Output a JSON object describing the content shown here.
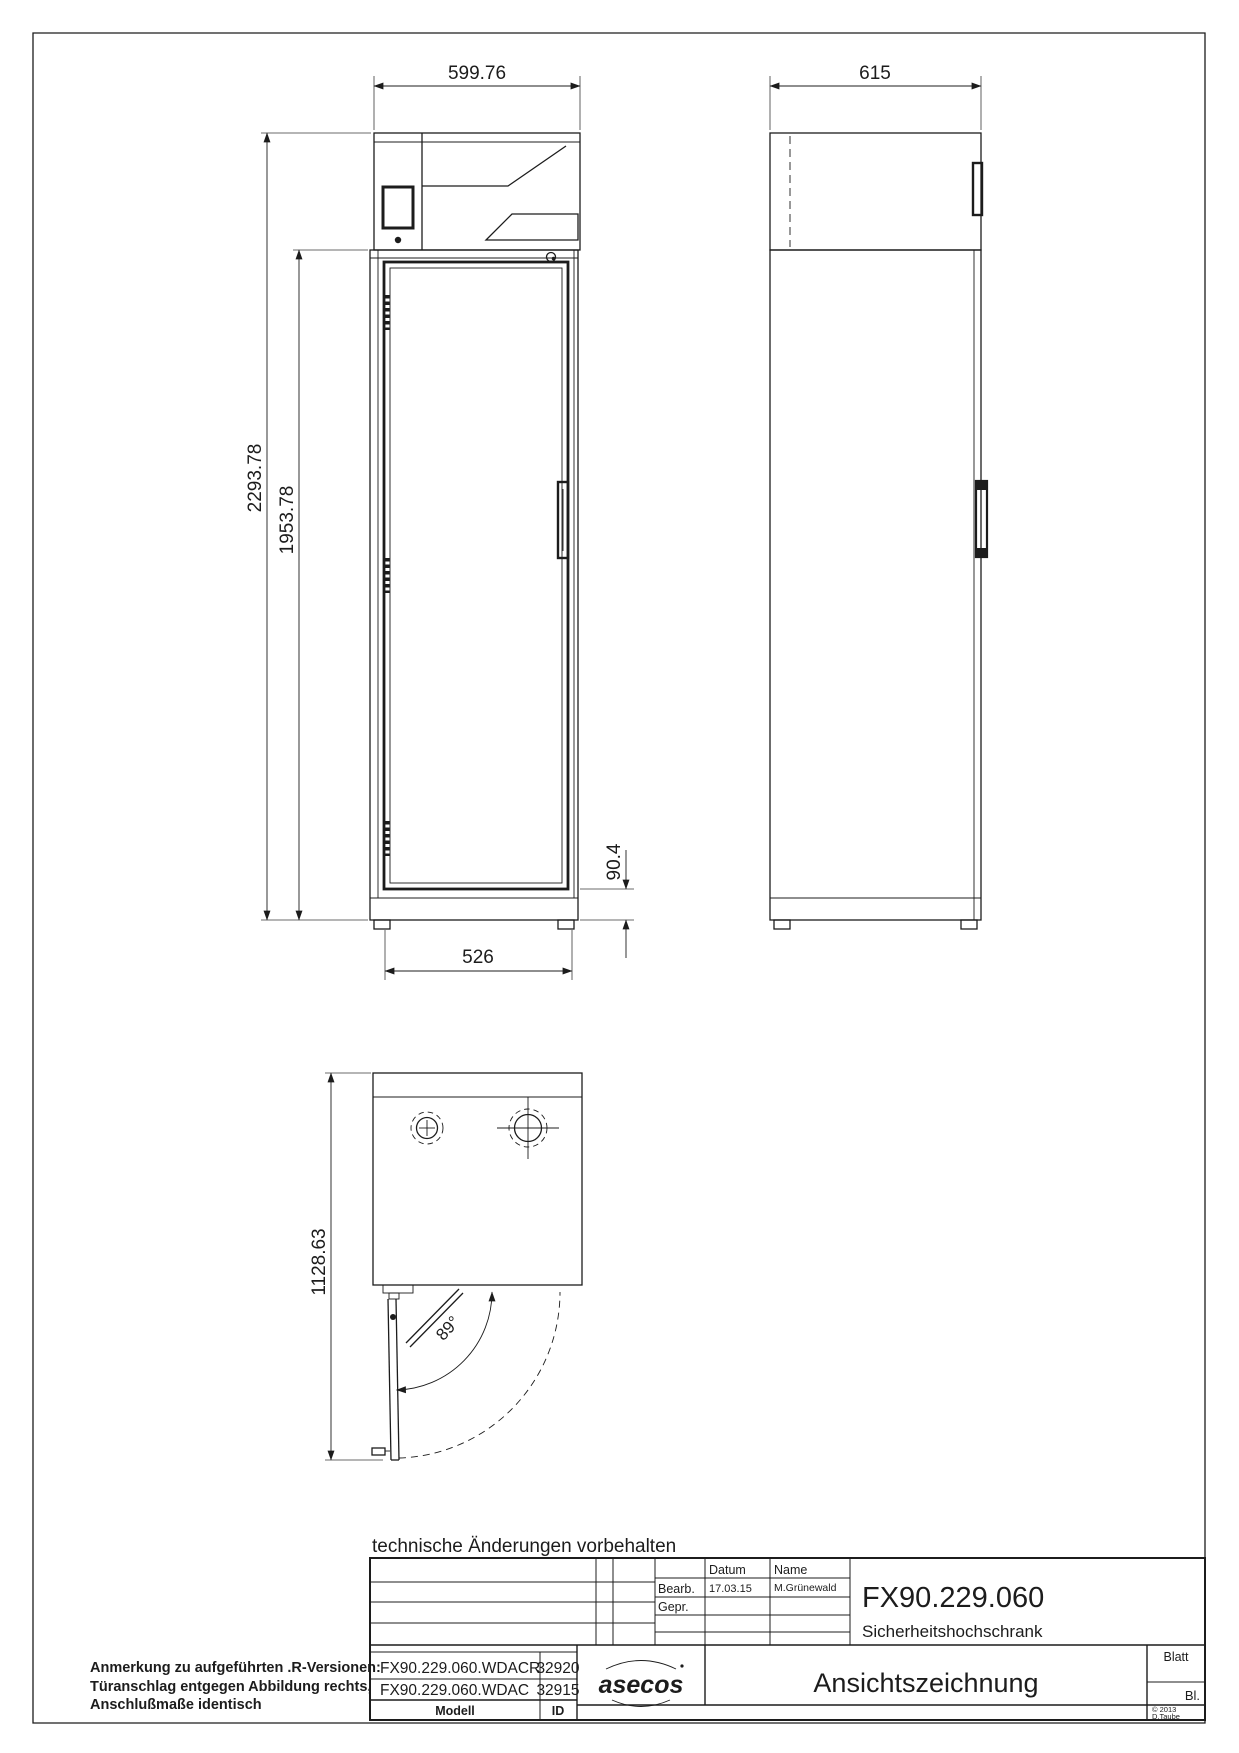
{
  "notes": {
    "footer": "technische Änderungen vorbehalten",
    "remark_line1": "Anmerkung zu aufgeführten .R-Versionen:",
    "remark_line2": "Türanschlag entgegen Abbildung rechts,",
    "remark_line3": "Anschlußmaße identisch"
  },
  "dimensions": {
    "front_width": "599.76",
    "total_height": "2293.78",
    "body_height": "1953.78",
    "door_opening_width": "526",
    "base_height": "90.4",
    "side_depth": "615",
    "plan_depth_door_open": "1128.63",
    "door_opening_angle": "89°"
  },
  "title_block": {
    "col_datum": "Datum",
    "col_name": "Name",
    "row_bearb": "Bearb.",
    "row_gepr": "Gepr.",
    "bearb_date": "17.03.15",
    "bearb_name": "M.Grünewald",
    "part_number": "FX90.229.060",
    "part_name": "Sicherheitshochschrank",
    "models": [
      {
        "modell": "FX90.229.060.WDACR",
        "id": "32920"
      },
      {
        "modell": "FX90.229.060.WDAC",
        "id": "32915"
      }
    ],
    "col_modell": "Modell",
    "col_id": "ID",
    "logo": "asecos",
    "drawing_title": "Ansichtszeichnung",
    "sheet_label": "Blatt",
    "sheet_value": "Bl.",
    "copyright": "© 2013",
    "copyright_author": "D.Taube"
  },
  "colors": {
    "line": "#1c1c1c",
    "background": "#ffffff"
  }
}
